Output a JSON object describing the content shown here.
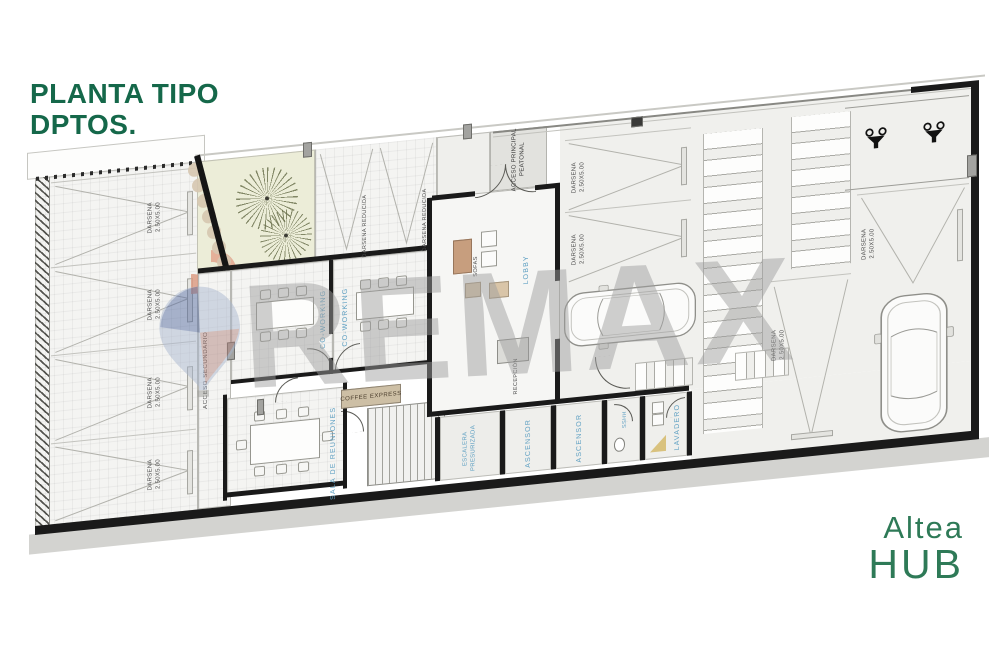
{
  "header": {
    "l1": "PLANTA TIPO",
    "l2": "DPTOS.",
    "color": "#15684a"
  },
  "brand": {
    "l1": "Altea",
    "l2": "HUB",
    "color": "#2e7a57"
  },
  "watermark": {
    "text": "REMAX",
    "text_color": "#9e9e9e",
    "balloon_blue": "#53699f",
    "balloon_red": "#b0837d"
  },
  "plan": {
    "labels": {
      "darsena": "DARSENA",
      "darsena_size": "2.50X5.00",
      "darsena_reducida": "DARSENA REDUCIDA",
      "acceso_secundario": "ACCESO SECUNDARIO",
      "acceso_principal_l1": "ACCESO PRINCIPAL",
      "acceso_principal_l2": "PEATONAL",
      "coworking": "CO-WORKING",
      "sala_reuniones": "SALA DE REUNIONES",
      "coffee_express": "COFFEE EXPRESS",
      "lobby": "LOBBY",
      "sofas": "SOFAS",
      "recepcion": "RECEPCIÓN",
      "escalera_l1": "ESCALERA",
      "escalera_l2": "PRESURIZADA",
      "ascensor": "ASCENSOR",
      "sshh": "SSHH",
      "lavadero": "LAVADERO"
    },
    "colors": {
      "wall": "#1a1a1a",
      "room_label_blue": "#5d9fc2",
      "garden": "#ecedd8",
      "coffee_tan": "#cdbfa5",
      "salmon": "#e3a892",
      "floor": "#f4f4f2"
    }
  }
}
